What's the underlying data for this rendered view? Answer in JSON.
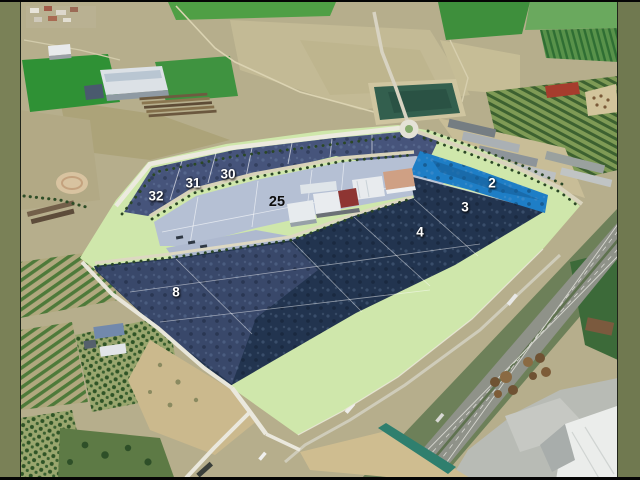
{
  "title": "Aerial photograph of an industrial park development with numbered parcels",
  "frame": {
    "left_border_color": "#7a8157",
    "right_border_color": "#707950",
    "top_edge_color": "#000000",
    "bottom_edge_color": "#000000"
  },
  "parcels": [
    {
      "number": "32",
      "style": "white-on-navy"
    },
    {
      "number": "31",
      "style": "white-on-navy"
    },
    {
      "number": "30",
      "style": "white-on-navy"
    },
    {
      "number": "25",
      "style": "black-on-light"
    },
    {
      "number": "2",
      "style": "white-on-blue-highlight"
    },
    {
      "number": "3",
      "style": "white-on-navy"
    },
    {
      "number": "4",
      "style": "white-on-navy"
    },
    {
      "number": "8",
      "style": "white-on-navy"
    }
  ],
  "colors": {
    "frame_olive": "#7a8157",
    "parcel_navy": "#24364f",
    "parcel_slate": "#46547b",
    "parcel_light": "#b5c0d4",
    "parcel_highlight_blue": "#1e7ec6",
    "greenbelt_pale": "#cfe7ab",
    "label_white": "#ffffff",
    "label_black": "#0d0d0d"
  }
}
